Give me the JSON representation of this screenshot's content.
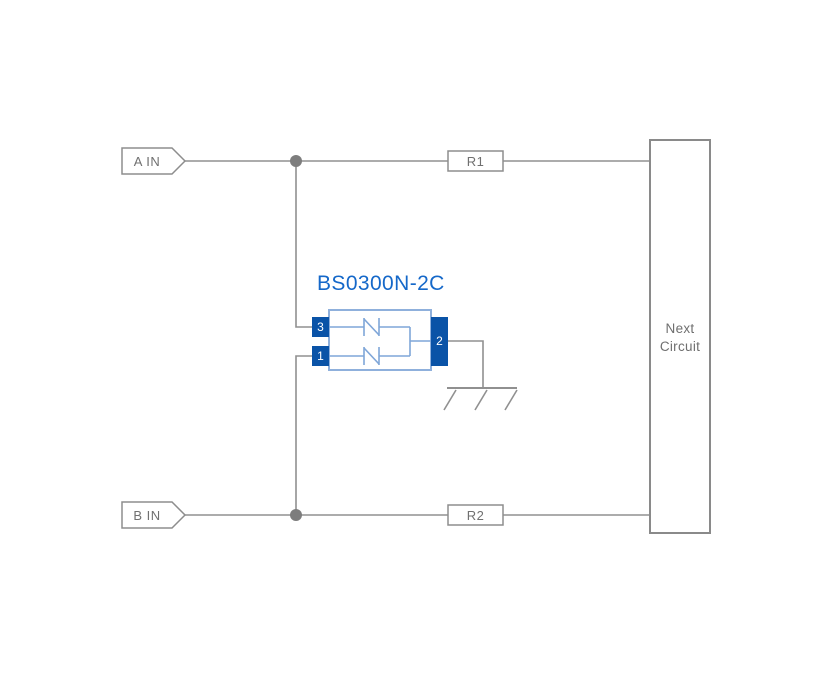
{
  "diagram": {
    "inputs": [
      {
        "label": "A IN"
      },
      {
        "label": "B IN"
      }
    ],
    "resistors": [
      {
        "label": "R1"
      },
      {
        "label": "R2"
      }
    ],
    "next_circuit": {
      "line1": "Next",
      "line2": "Circuit"
    },
    "component": {
      "name": "BS0300N-2C",
      "pin_top_left": "3",
      "pin_bottom_left": "1",
      "pin_right": "2"
    }
  },
  "colors": {
    "wire": "#909090",
    "junction_dot": "#7d7d7d",
    "shape_outline": "#8d8d8d",
    "label_text": "#707070",
    "component_title": "#1568c9",
    "component_body_outline": "#8fb0dc",
    "component_inner_wire": "#7fa6d8",
    "pin_fill": "#0a53a7",
    "pin_text": "#ffffff"
  }
}
